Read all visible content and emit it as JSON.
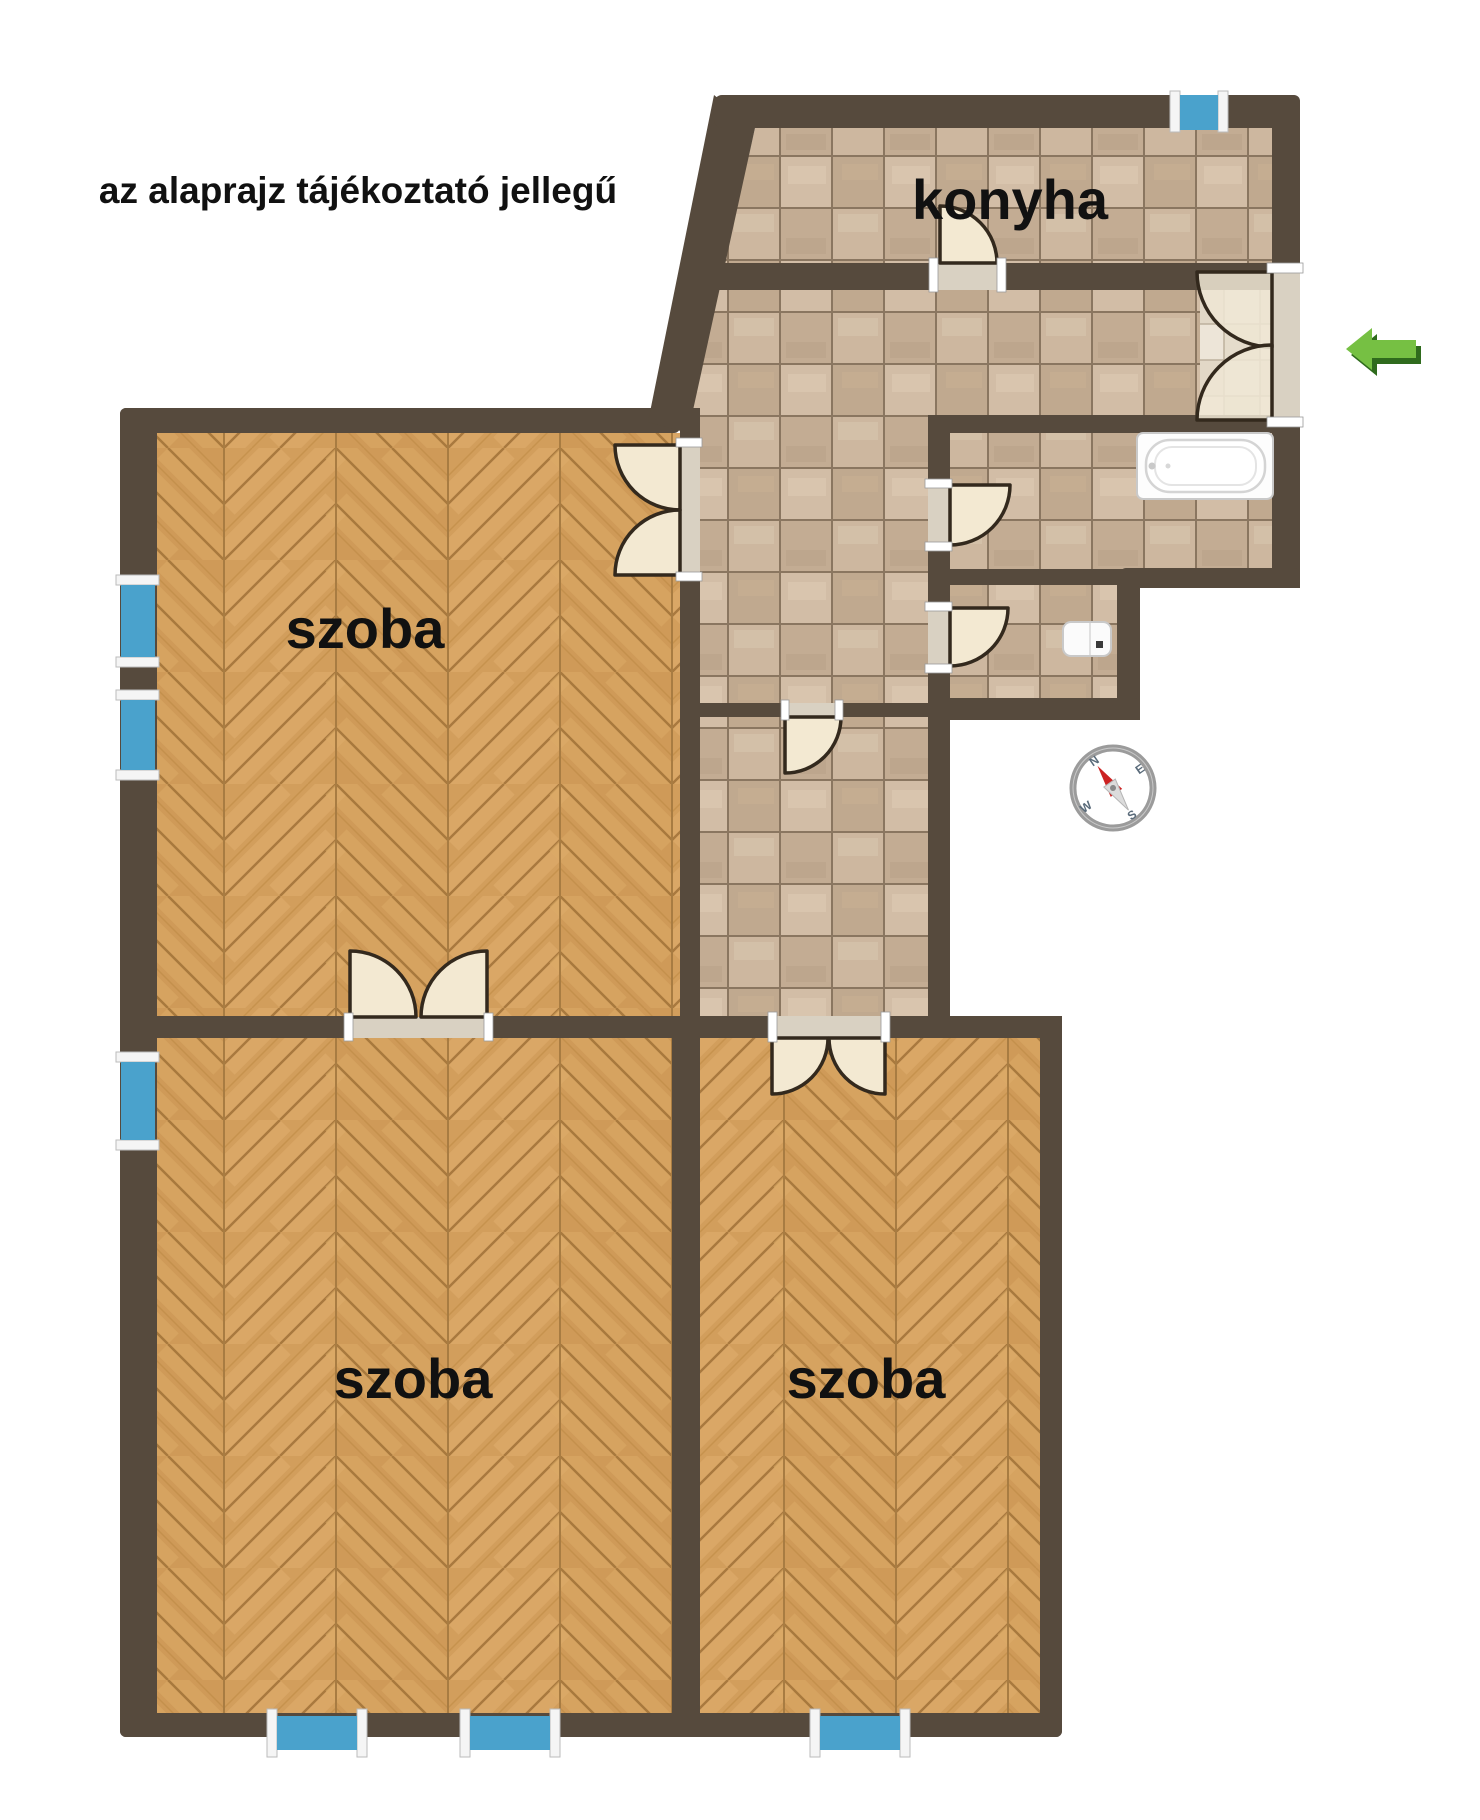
{
  "disclaimer": "az alaprajz tájékoztató jellegű",
  "rooms": {
    "kitchen": {
      "label": "konyha"
    },
    "room_top_left": {
      "label": "szoba"
    },
    "room_bottom_left": {
      "label": "szoba"
    },
    "room_bottom_right": {
      "label": "szoba"
    }
  },
  "compass": {
    "north": "N",
    "east": "E",
    "south": "S",
    "west": "W"
  },
  "fixtures": {
    "bathtub": "bathtub",
    "toilet": "toilet"
  },
  "colors": {
    "wall": "#564a3d",
    "window": "#4aa2cc",
    "door_leaf": "#f3e9d2",
    "door_outline": "#33291d",
    "parquet_base": "#cf9a58",
    "tile_base": "#c9b49c",
    "tile_grout": "#8a7660",
    "entrance_arrow": "#76c043",
    "entrance_arrow_shadow": "#2f6b1d",
    "compass_needle": "#cc2222",
    "label_text": "#111111"
  }
}
